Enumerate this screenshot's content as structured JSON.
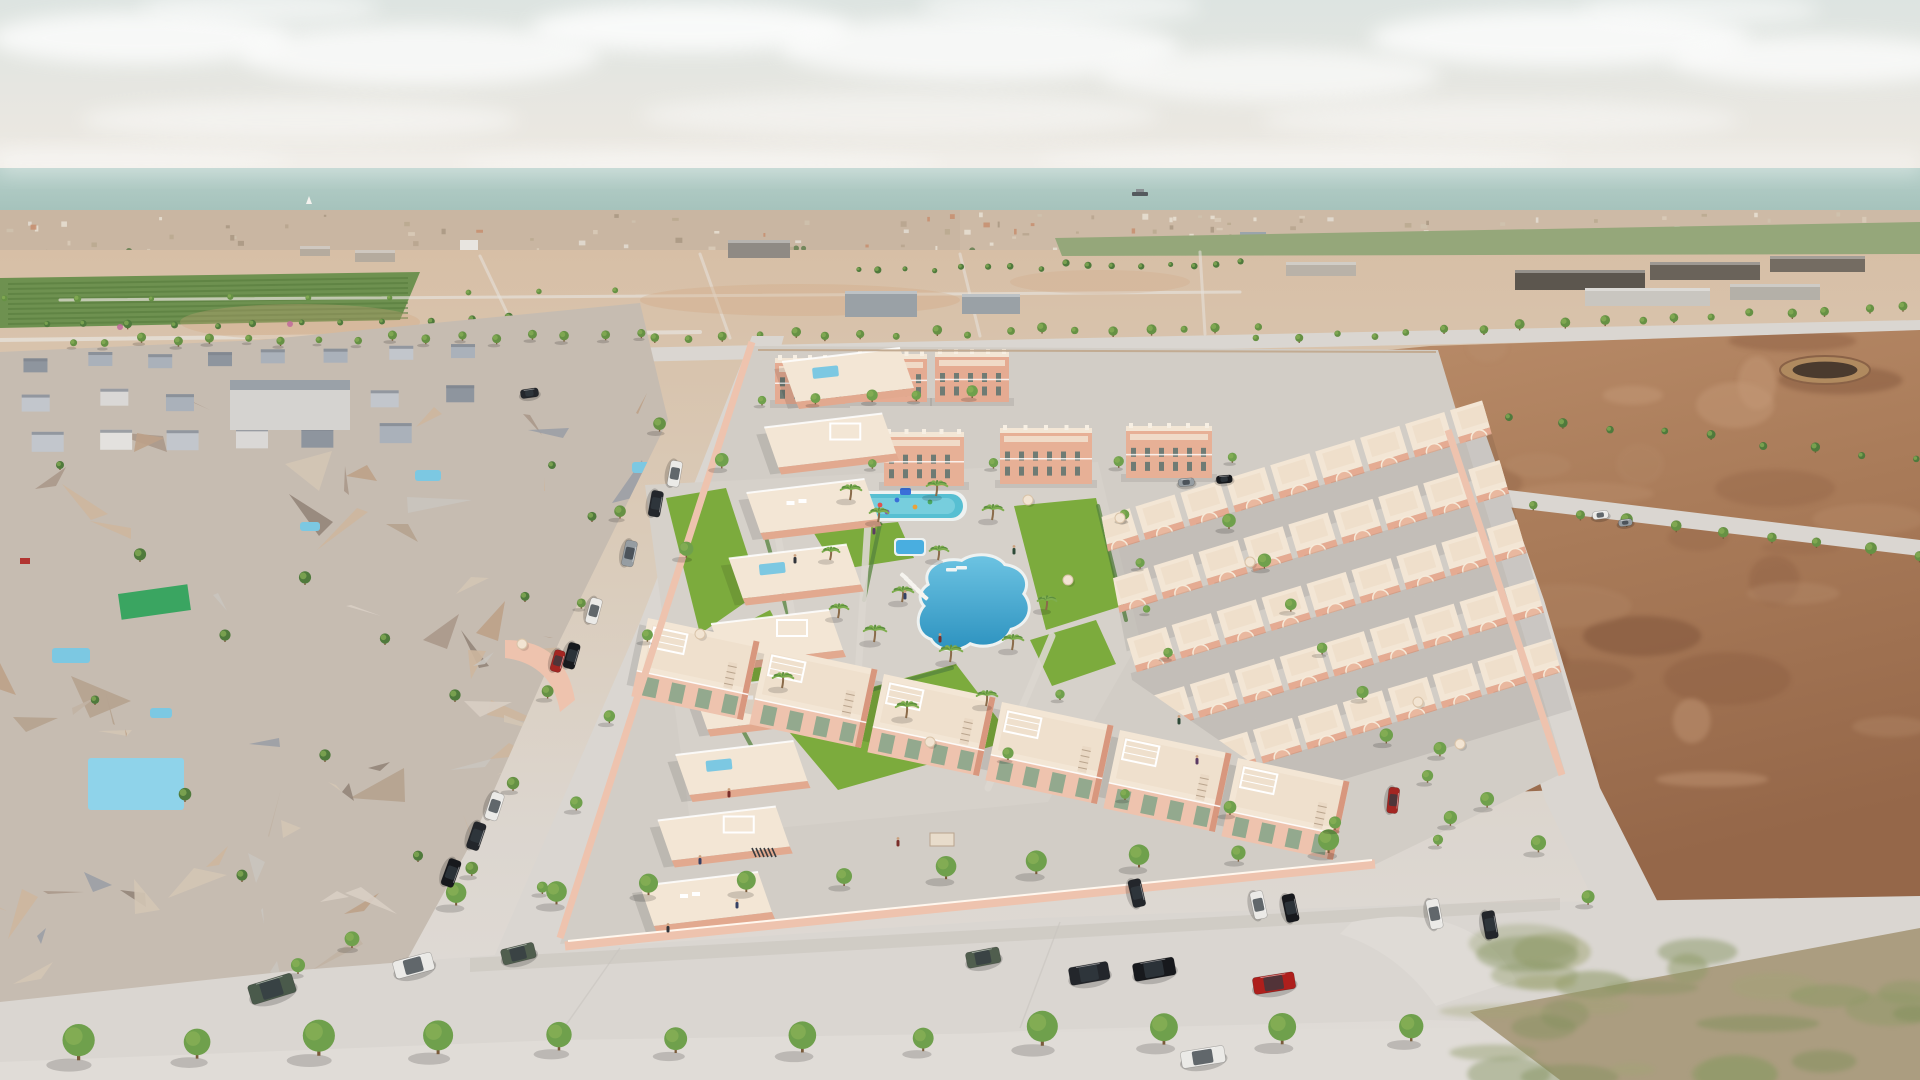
{
  "scene": {
    "description": "Aerial 3D architectural render of a new salmon-coloured coastal residential development with communal pools, surrounded by photogrammetry terrain, empty dirt plots, tree-lined streets and parked cars, sea on the horizon",
    "type": "3d-aerial-render",
    "palette": {
      "sky1": "#dde4e1",
      "sky2": "#e9e7e1",
      "sky3": "#efeae2",
      "sea1": "#b6cfc9",
      "sea2": "#a3c1ba",
      "skylineA": "#cdbaa6",
      "skylineB": "#c9b6a2",
      "ground1": "#d7bfa6",
      "ground2": "#dacbb9",
      "ground3": "#dcd6cf",
      "ground4": "#e0dcd8",
      "farm": "#6e9150",
      "fieldR": "#95a77a",
      "dirt1": "#bb8e6b",
      "dirt2": "#a87a58",
      "dirt3": "#956749",
      "road": "#dad6d1",
      "roadLight": "#e0dcd7",
      "sidewalk": "#dfdbd6",
      "oldBase": "#c6bcb1",
      "salmon": "#e5ab92",
      "salmonLight": "#eec3ae",
      "salmonDark": "#d8977e",
      "cream": "#f3e6d5",
      "creamWhite": "#f7efe3",
      "paving": "#d2cdc6",
      "pavingLight": "#d6d1ca",
      "lawn": "#7cab3d",
      "hedge": "#56843e",
      "pool1": "#6cc3e2",
      "pool2": "#2e93c0",
      "poolKid": "#57bfd2",
      "poolRim": "#eef2f1",
      "treeDark": "#4f7a3c",
      "treeMid": "#669144",
      "treeBright": "#6fa04c",
      "treeLight": "#8ab157",
      "trunk": "#7a5b3a",
      "glass": "#93a98e",
      "carWhite": "#ebeae7",
      "carBlack": "#23262b",
      "carBlack2": "#17191d",
      "carGrey": "#969da2",
      "carRed": "#ae1f1c",
      "carRed2": "#a32622",
      "carGreen": "#4a5a4b",
      "carGreen2": "#505e4e"
    },
    "clouds": [
      [
        140,
        38,
        150,
        26,
        0.75
      ],
      [
        420,
        55,
        180,
        30,
        0.7
      ],
      [
        690,
        28,
        160,
        24,
        0.8
      ],
      [
        980,
        48,
        200,
        32,
        0.7
      ],
      [
        1270,
        75,
        170,
        26,
        0.6
      ],
      [
        1560,
        38,
        190,
        28,
        0.75
      ],
      [
        1820,
        60,
        150,
        24,
        0.7
      ],
      [
        300,
        120,
        220,
        20,
        0.45
      ],
      [
        900,
        115,
        260,
        22,
        0.4
      ],
      [
        1500,
        120,
        240,
        20,
        0.4
      ],
      [
        90,
        160,
        200,
        14,
        0.3
      ],
      [
        700,
        165,
        240,
        14,
        0.3
      ],
      [
        1300,
        160,
        260,
        14,
        0.3
      ],
      [
        260,
        8,
        120,
        16,
        0.5
      ],
      [
        1060,
        6,
        140,
        18,
        0.5
      ],
      [
        1700,
        10,
        120,
        16,
        0.5
      ]
    ],
    "sea": {
      "ship": [
        1140,
        194
      ],
      "sailboat": [
        309,
        204
      ]
    },
    "skyline": {
      "count": 170,
      "band_near": [
        212,
        286
      ],
      "band_far": [
        212,
        252
      ],
      "landmarks": [
        [
          585,
          262,
          30,
          16,
          "#5a6b7c"
        ],
        [
          460,
          240,
          18,
          13,
          "#e8e5e0"
        ],
        [
          1240,
          232,
          26,
          12,
          "#9aa4ab"
        ]
      ]
    },
    "warehouses": [
      [
        845,
        291,
        72,
        26,
        "#9aa1a6"
      ],
      [
        962,
        294,
        58,
        20,
        "#9aa1a6"
      ],
      [
        728,
        240,
        62,
        18,
        "#8f8a84"
      ],
      [
        355,
        250,
        40,
        12,
        "#b5ab9e"
      ],
      [
        300,
        246,
        30,
        10,
        "#b5ab9e"
      ],
      [
        1515,
        270,
        130,
        20,
        "#5c564e"
      ],
      [
        1650,
        262,
        110,
        18,
        "#6a635a"
      ],
      [
        1770,
        256,
        95,
        16,
        "#746c62"
      ],
      [
        1585,
        288,
        125,
        18,
        "#c9c6c0"
      ],
      [
        1730,
        284,
        90,
        16,
        "#b4b0a8"
      ],
      [
        1286,
        262,
        70,
        14,
        "#b9b2a8"
      ]
    ],
    "circle_feature": {
      "x": 1825,
      "y": 370,
      "rx": 45,
      "ry": 14
    },
    "old_town": {
      "triangles": 95,
      "pools": [
        [
          88,
          758,
          96,
          52
        ],
        [
          52,
          648,
          38,
          15
        ],
        [
          415,
          470,
          26,
          11
        ],
        [
          150,
          708,
          22,
          10
        ],
        [
          632,
          462,
          26,
          11
        ],
        [
          300,
          522,
          20,
          9
        ]
      ],
      "green_roof": [
        118,
        594,
        70,
        26
      ],
      "trees": [
        [
          60,
          470,
          5
        ],
        [
          140,
          562,
          5
        ],
        [
          225,
          642,
          6
        ],
        [
          95,
          705,
          5
        ],
        [
          305,
          585,
          5
        ],
        [
          385,
          645,
          5
        ],
        [
          185,
          802,
          6
        ],
        [
          325,
          762,
          5
        ],
        [
          455,
          702,
          5
        ],
        [
          525,
          602,
          4
        ],
        [
          592,
          522,
          4
        ],
        [
          242,
          882,
          6
        ],
        [
          418,
          862,
          6
        ],
        [
          552,
          470,
          4
        ],
        [
          620,
          560,
          4
        ]
      ],
      "red_speck": [
        20,
        558
      ]
    },
    "tree_rows": [
      [
        0,
        330,
        640,
        322,
        16,
        3.5,
        "treeDark",
        "far"
      ],
      [
        0,
        302,
        620,
        296,
        9,
        3,
        "treeMid",
        "far"
      ],
      [
        855,
        272,
        1245,
        268,
        16,
        3,
        "treeDark",
        "far"
      ],
      [
        438,
        345,
        1255,
        333,
        24,
        4,
        "treeMid",
        "far"
      ],
      [
        1258,
        344,
        1905,
        313,
        18,
        4,
        "treeMid",
        "far"
      ],
      [
        1205,
        472,
        1916,
        560,
        16,
        5,
        "treeMid",
        "far"
      ],
      [
        1310,
        400,
        1914,
        464,
        13,
        4,
        "treeDark",
        "far"
      ],
      [
        1230,
        528,
        1455,
        828,
        8,
        6,
        "treeBright",
        "near"
      ],
      [
        1438,
        758,
        1590,
        902,
        4,
        7,
        "treeBright",
        "near"
      ],
      [
        660,
        432,
        472,
        878,
        6,
        5.5,
        "treeMid",
        "near"
      ],
      [
        70,
        346,
        640,
        340,
        17,
        4,
        "treeMid",
        "near"
      ],
      [
        722,
        470,
        540,
        894,
        6,
        6,
        "treeBright",
        "near"
      ],
      [
        458,
        908,
        1332,
        854,
        10,
        8.5,
        "treeBright",
        "near"
      ],
      [
        74,
        1058,
        1408,
        1044,
        12,
        13,
        "treeBright",
        "near"
      ],
      [
        766,
        404,
        972,
        398,
        5,
        5,
        "treeBright",
        "near"
      ],
      [
        872,
        470,
        1235,
        465,
        4,
        4.5,
        "treeBright",
        "near"
      ],
      [
        1122,
        522,
        1164,
        660,
        4,
        4,
        "treeBright",
        "near"
      ]
    ],
    "scatter_trees": [
      [
        352,
        948,
        7
      ],
      [
        298,
        974,
        7
      ],
      [
        1125,
        800,
        6
      ],
      [
        1230,
        815,
        6
      ],
      [
        1335,
        830,
        6
      ],
      [
        1438,
        846,
        6
      ],
      [
        1060,
        700,
        5
      ],
      [
        1008,
        760,
        5
      ]
    ],
    "pink_trees": [
      [
        120,
        327
      ],
      [
        290,
        324
      ],
      [
        470,
        322
      ],
      [
        600,
        320
      ]
    ],
    "palms": [
      [
        850,
        500,
        11
      ],
      [
        936,
        496,
        11
      ],
      [
        878,
        522,
        10
      ],
      [
        992,
        520,
        11
      ],
      [
        938,
        560,
        10
      ],
      [
        902,
        602,
        11
      ],
      [
        874,
        642,
        12
      ],
      [
        950,
        662,
        12
      ],
      [
        1012,
        650,
        11
      ],
      [
        830,
        560,
        9
      ],
      [
        838,
        618,
        10
      ],
      [
        782,
        688,
        11
      ],
      [
        906,
        718,
        12
      ],
      [
        986,
        706,
        11
      ],
      [
        1046,
        610,
        10
      ]
    ],
    "umbrellas": [
      [
        700,
        634
      ],
      [
        930,
        742
      ],
      [
        1250,
        562
      ],
      [
        1418,
        702
      ],
      [
        1460,
        744
      ],
      [
        1120,
        518
      ],
      [
        522,
        644
      ],
      [
        1028,
        500
      ],
      [
        1068,
        580
      ]
    ],
    "loungers": {
      "x0": 902,
      "y0": 572,
      "x1": 922,
      "y1": 592,
      "n": 6
    },
    "people": [
      [
        905,
        598
      ],
      [
        940,
        641
      ],
      [
        1014,
        553
      ],
      [
        874,
        533
      ],
      [
        795,
        562
      ],
      [
        700,
        863
      ],
      [
        729,
        796
      ],
      [
        1179,
        723
      ],
      [
        1197,
        763
      ],
      [
        668,
        931
      ],
      [
        737,
        907
      ],
      [
        898,
        845
      ]
    ],
    "playground": {
      "base": [
        796,
        492,
        46,
        28
      ],
      "dots": [
        [
          880,
          505,
          "#e0524d"
        ],
        [
          897,
          500,
          "#3a6fd8"
        ],
        [
          915,
          507,
          "#e8a23b"
        ],
        [
          930,
          502,
          "#4aa860"
        ],
        [
          887,
          512,
          "#8456b0"
        ]
      ],
      "canopy": [
        900,
        488,
        11,
        7,
        "#3a6fd8"
      ]
    },
    "pools": {
      "kid": [
        845,
        494,
        118,
        24
      ],
      "small": [
        896,
        540,
        28,
        14
      ],
      "big_path": "M 930,585 C 922,568 944,558 962,562 C 976,552 998,556 1004,566 C 1022,568 1030,582 1022,594 C 1034,608 1026,624 1010,628 C 1004,644 984,648 970,642 C 958,652 938,650 932,638 C 918,634 916,616 926,606 C 918,598 922,590 930,585 Z",
      "steps": [
        [
          946,
          568
        ],
        [
          956,
          566
        ]
      ]
    },
    "lawns": [
      "666,498 726,488 760,592 700,634",
      "700,646 770,610 806,678 738,722",
      "812,530 898,522 914,558 836,570",
      "1014,506 1096,498 1122,606 1046,630",
      "774,714 956,664 1014,740 838,790",
      "936,566 990,556 1004,580 952,592",
      "1030,640 1096,620 1116,664 1052,686"
    ],
    "hedges": [
      [
        756,
        502,
        794,
        636
      ],
      [
        700,
        652,
        758,
        758
      ],
      [
        880,
        524,
        864,
        600
      ],
      [
        1098,
        506,
        1126,
        620
      ],
      [
        812,
        706,
        952,
        668
      ]
    ],
    "paths": [
      [
        770,
        492,
        798,
        648
      ],
      [
        868,
        522,
        856,
        706
      ],
      [
        1052,
        636,
        988,
        788
      ]
    ],
    "feature_pergola": [
      905,
      698,
      26,
      12
    ],
    "entrance_sign": [
      930,
      833,
      24,
      13
    ],
    "bikes": {
      "x": 752,
      "y": 848,
      "n": 6
    },
    "apartments_row_a": [
      [
        775,
        358,
        70,
        46
      ],
      [
        855,
        354,
        72,
        48
      ],
      [
        935,
        352,
        74,
        50
      ]
    ],
    "apartments_row_b": [
      [
        884,
        432,
        80,
        54
      ],
      [
        1000,
        428,
        92,
        56
      ],
      [
        1126,
        426,
        86,
        52
      ]
    ],
    "left_row": {
      "ax": 782,
      "ay": 362,
      "bx": 640,
      "by": 886,
      "n": 9
    },
    "right_block": {
      "x0": 1120,
      "x1": 1545,
      "y0": 462,
      "y1": 760,
      "dx": 47,
      "dy": 62,
      "rot": -17
    },
    "south_row": [
      [
        648,
        618
      ],
      [
        766,
        646
      ],
      [
        884,
        674
      ],
      [
        1002,
        702
      ],
      [
        1120,
        730
      ],
      [
        1238,
        758
      ]
    ],
    "cars": [
      [
        247,
        986,
        46,
        20,
        -17,
        "carGreen"
      ],
      [
        392,
        962,
        40,
        18,
        -15,
        "carWhite"
      ],
      [
        500,
        950,
        34,
        16,
        -14,
        "carGreen2"
      ],
      [
        965,
        953,
        34,
        16,
        -11,
        "carGreen2"
      ],
      [
        1068,
        968,
        40,
        18,
        -10,
        "carBlack"
      ],
      [
        1132,
        964,
        42,
        18,
        -10,
        "carBlack2"
      ],
      [
        1252,
        978,
        42,
        17,
        -9,
        "carRed"
      ],
      [
        1180,
        1052,
        44,
        17,
        -9,
        "carWhite"
      ],
      [
        683,
        462,
        26,
        12,
        100,
        "carWhite"
      ],
      [
        664,
        492,
        26,
        12,
        100,
        "carBlack"
      ],
      [
        638,
        542,
        26,
        12,
        102,
        "carGrey"
      ],
      [
        603,
        600,
        26,
        12,
        105,
        "carWhite"
      ],
      [
        581,
        645,
        26,
        12,
        106,
        "carBlack2"
      ],
      [
        566,
        652,
        22,
        11,
        106,
        "carRed2"
      ],
      [
        505,
        795,
        28,
        13,
        108,
        "carWhite"
      ],
      [
        487,
        825,
        28,
        13,
        109,
        "carBlack"
      ],
      [
        462,
        862,
        28,
        13,
        110,
        "carBlack2"
      ],
      [
        1140,
        878,
        28,
        13,
        77,
        "carBlack"
      ],
      [
        1262,
        890,
        28,
        13,
        78,
        "carWhite"
      ],
      [
        1294,
        893,
        28,
        13,
        78,
        "carBlack2"
      ],
      [
        1438,
        898,
        30,
        13,
        79,
        "carWhite"
      ],
      [
        1494,
        910,
        28,
        13,
        80,
        "carBlack"
      ],
      [
        1400,
        788,
        26,
        11,
        96,
        "carRed2"
      ],
      [
        1592,
        512,
        16,
        8,
        -7,
        "carWhite"
      ],
      [
        1618,
        520,
        14,
        7,
        -7,
        "carGrey"
      ],
      [
        1178,
        479,
        16,
        8,
        -5,
        "carGrey"
      ],
      [
        1216,
        476,
        16,
        8,
        -5,
        "carBlack2"
      ],
      [
        520,
        390,
        18,
        9,
        -8,
        "carBlack"
      ]
    ],
    "dirt_mottle": {
      "count": 52,
      "box": [
        1160,
        340,
        740,
        480
      ]
    },
    "grass_blobs": {
      "count": 26,
      "box": [
        1480,
        935,
        440,
        145
      ]
    }
  }
}
